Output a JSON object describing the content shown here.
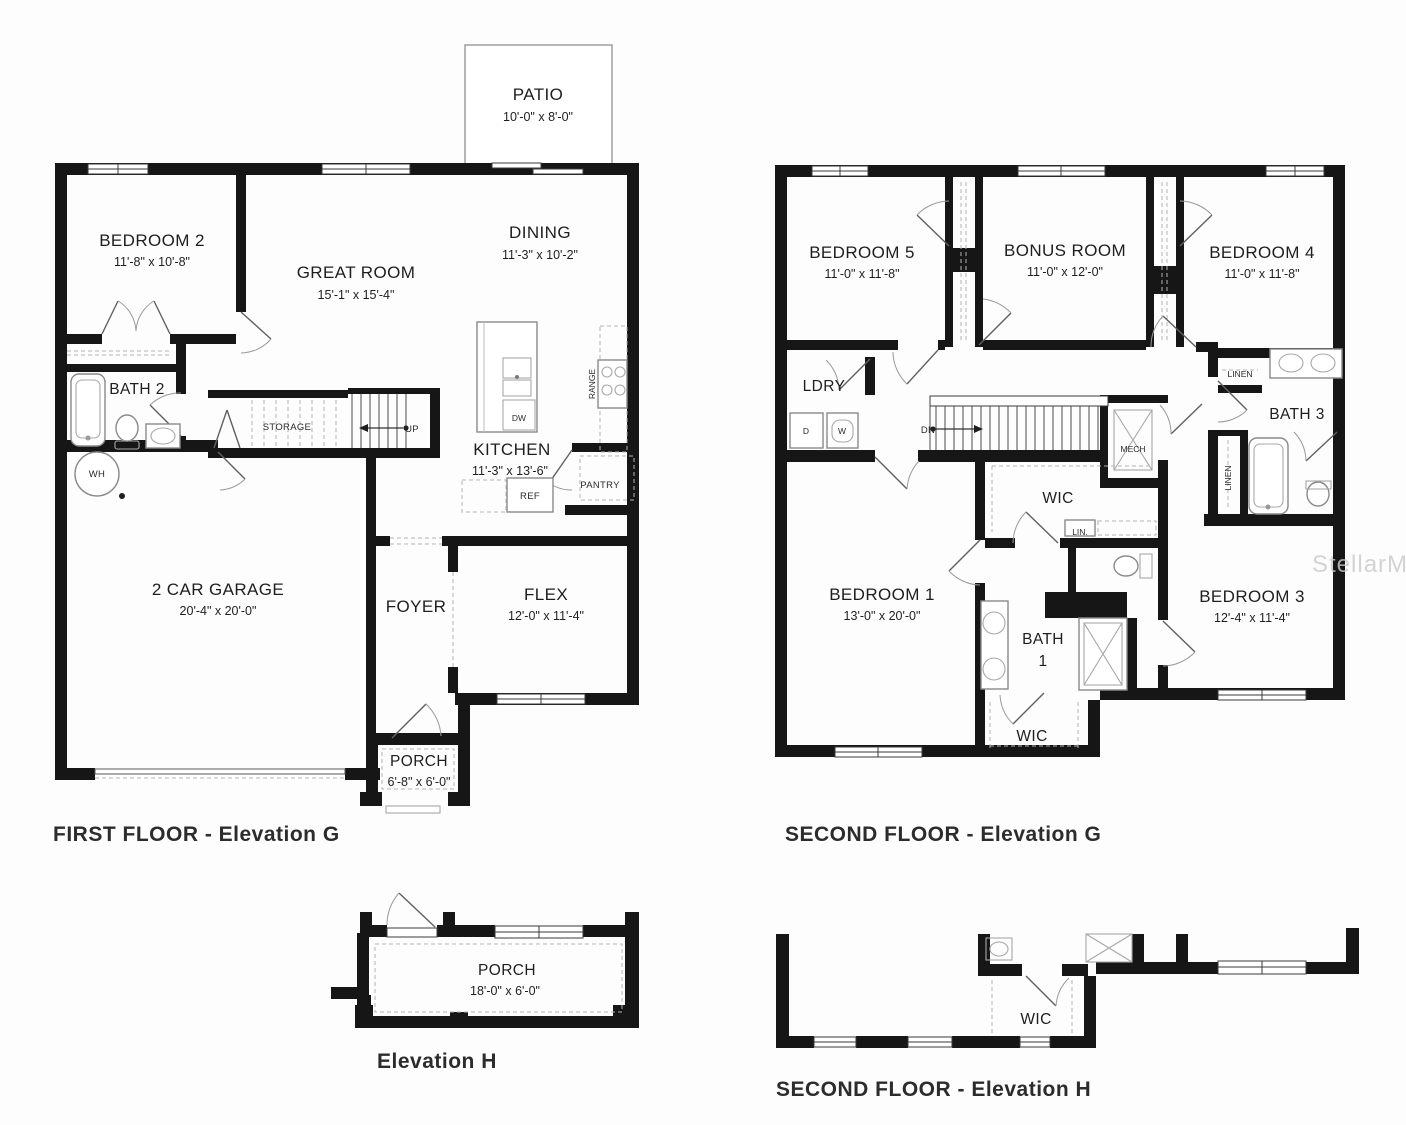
{
  "watermark": "StellarMLS",
  "panels": {
    "first_floor_g": {
      "caption": "FIRST FLOOR - Elevation G",
      "patio": {
        "label": "PATIO",
        "dims": "10'-0\" x 8'-0\""
      },
      "bedroom2": {
        "label": "BEDROOM 2",
        "dims": "11'-8\" x 10'-8\""
      },
      "great_room": {
        "label": "GREAT ROOM",
        "dims": "15'-1\" x 15'-4\""
      },
      "dining": {
        "label": "DINING",
        "dims": "11'-3\" x 10'-2\""
      },
      "bath2": {
        "label": "BATH 2"
      },
      "kitchen": {
        "label": "KITCHEN",
        "dims": "11'-3\" x 13'-6\""
      },
      "garage": {
        "label": "2 CAR GARAGE",
        "dims": "20'-4\" x 20'-0\""
      },
      "foyer": {
        "label": "FOYER"
      },
      "flex": {
        "label": "FLEX",
        "dims": "12'-0\" x 11'-4\""
      },
      "porch": {
        "label": "PORCH",
        "dims": "6'-8\" x 6'-0\""
      },
      "storage": {
        "label": "STORAGE"
      },
      "up": {
        "label": "UP"
      },
      "pantry": {
        "label": "PANTRY"
      },
      "ref": {
        "label": "REF"
      },
      "dw": {
        "label": "DW"
      },
      "range": {
        "label": "RANGE"
      },
      "wh": {
        "label": "WH"
      }
    },
    "second_floor_g": {
      "caption": "SECOND FLOOR - Elevation G",
      "bedroom5": {
        "label": "BEDROOM 5",
        "dims": "11'-0\" x 11'-8\""
      },
      "bonus_room": {
        "label": "BONUS ROOM",
        "dims": "11'-0\" x 12'-0\""
      },
      "bedroom4": {
        "label": "BEDROOM 4",
        "dims": "11'-0\" x 11'-8\""
      },
      "ldry": {
        "label": "LDRY"
      },
      "dryer": {
        "label": "D"
      },
      "washer": {
        "label": "W"
      },
      "dn": {
        "label": "DN"
      },
      "mech": {
        "label": "MECH"
      },
      "linen_hall": {
        "label": "LINEN"
      },
      "bath3": {
        "label": "BATH 3"
      },
      "linen_bath": {
        "label": "LINEN"
      },
      "wic_bed1": {
        "label": "WIC"
      },
      "lin": {
        "label": "LIN."
      },
      "bedroom1": {
        "label": "BEDROOM 1",
        "dims": "13'-0\" x 20'-0\""
      },
      "bath1_line1": {
        "label": "BATH"
      },
      "bath1_line2": {
        "label": "1"
      },
      "bedroom3": {
        "label": "BEDROOM 3",
        "dims": "12'-4\" x 11'-4\""
      },
      "wic_lower": {
        "label": "WIC"
      }
    },
    "elevation_h": {
      "caption": "Elevation H",
      "porch": {
        "label": "PORCH",
        "dims": "18'-0\" x 6'-0\""
      }
    },
    "second_floor_h": {
      "caption": "SECOND FLOOR - Elevation H",
      "wic": {
        "label": "WIC"
      }
    }
  }
}
